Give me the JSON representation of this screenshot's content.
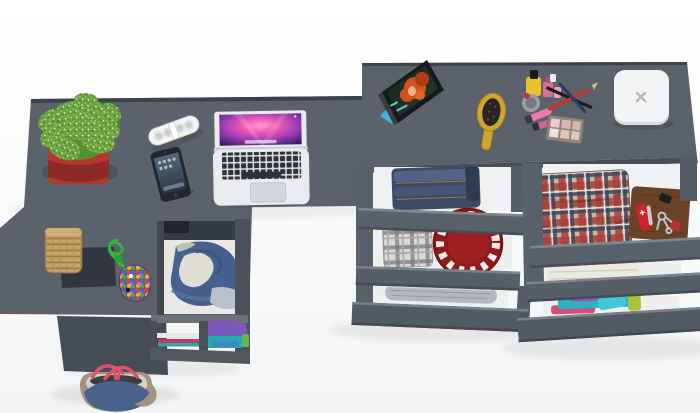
{
  "scene": {
    "title": "Top view 3D render of a dark gray L-shaped desk and dressing table with pulled-out drawers on a white floor",
    "view": "top-down",
    "background_color": "#ffffff"
  },
  "colors": {
    "furniture": "#5b626c",
    "furniture_mid": "#565d66",
    "furniture_dark": "#4a515a",
    "furniture_darker": "#454c55",
    "drawer_face": "#59616b",
    "drawer_interior": "#f0f1f2",
    "pot_red": "#b5382c",
    "pot_red_dark": "#8e2a24",
    "plant_green": "#6aa33f",
    "plant_green_dark": "#4e832c",
    "plant_green_light": "#8cc55a",
    "speaker_white": "#f4f4f4",
    "laptop_silver": "#e9ebed",
    "phone_black": "#23272e",
    "basket_tan": "#c3a169",
    "tray_dark": "#32373d",
    "cord_green": "#35b33a",
    "denim_blue": "#47618f",
    "shirt_cream": "#e9e5d8",
    "cloth_purple": "#7a57b8",
    "cloth_teal": "#2aa8b0",
    "cloth_pink": "#c23a64",
    "bag_denim": "#4a618a",
    "bag_trim": "#a39384",
    "bag_handle": "#e0526a",
    "jeans_dark": "#3c4a66",
    "jeans_light": "#53648a",
    "hat_red": "#9e1f1f",
    "leather_brown": "#6a4226",
    "knife_red": "#cc2428",
    "towel_cream": "#ece9e2",
    "brush_gold": "#d2a62e",
    "box_white": "#f2f3f4",
    "tablet_black": "#16181c",
    "hair_orange": "#d2511e"
  },
  "objects": [
    {
      "name": "l-shaped-desk",
      "description": "Dark gray L-shaped desk seen from above with an open clothes compartment and a small shelf below"
    },
    {
      "name": "dressing-table",
      "description": "Long dark gray dressing table with two chests of three pulled-out drawers"
    },
    {
      "name": "potted-plant",
      "description": "Green fern plant in a red square pot on the desk"
    },
    {
      "name": "portable-speaker",
      "description": "White pill-shaped portable speaker with four round grilles"
    },
    {
      "name": "macbook-laptop",
      "description": "Open silver laptop showing a pink-purple aurora wallpaper"
    },
    {
      "name": "smartphone",
      "description": "Black smartphone with dark blue home screen"
    },
    {
      "name": "wicker-basket",
      "description": "Tan woven basket standing on a dark square tray"
    },
    {
      "name": "bead-charm",
      "description": "Green cord with a pouch covered in multicolored beads"
    },
    {
      "name": "compartment-clothes",
      "description": "Blue denim and cream garments inside the open desk compartment"
    },
    {
      "name": "shelf-clothes",
      "description": "Purple, teal and pink folded clothes on the lower desk shelf"
    },
    {
      "name": "tote-bag",
      "description": "Denim tote bag with beige trim and red rope handles on the floor"
    },
    {
      "name": "tablet",
      "description": "Tablet propped on a stand showing a red-haired cartoon character"
    },
    {
      "name": "hairbrush",
      "description": "Gold oval hairbrush with dark bristles"
    },
    {
      "name": "cosmetics-set",
      "description": "Nail polish bottles, lipsticks, crossed pencils and an eyeshadow palette"
    },
    {
      "name": "white-box",
      "description": "White rounded square box with a small x logo"
    },
    {
      "name": "folded-jeans",
      "description": "Folded blue jeans in the first open drawer"
    },
    {
      "name": "gray-plaid-shirt",
      "description": "Folded gray plaid shirt in the second drawer"
    },
    {
      "name": "red-hat",
      "description": "Round red hat with white ornament in the second drawer"
    },
    {
      "name": "silver-pouch",
      "description": "Long silver-gray pouch in the third drawer"
    },
    {
      "name": "tartan-shirt",
      "description": "Folded red-blue tartan shirt in the right chest top drawer"
    },
    {
      "name": "leather-organizer",
      "description": "Brown leather case with Swiss knife, keys and key fob"
    },
    {
      "name": "white-towel",
      "description": "Folded white towel in the right chest middle drawer"
    },
    {
      "name": "colorful-clothes",
      "description": "Teal, purple, pink and yellow folded clothes in the right chest bottom drawer"
    }
  ],
  "counts": {
    "open_drawers_left_chest": 3,
    "open_drawers_right_chest": 3,
    "devices_on_desk": 3
  }
}
